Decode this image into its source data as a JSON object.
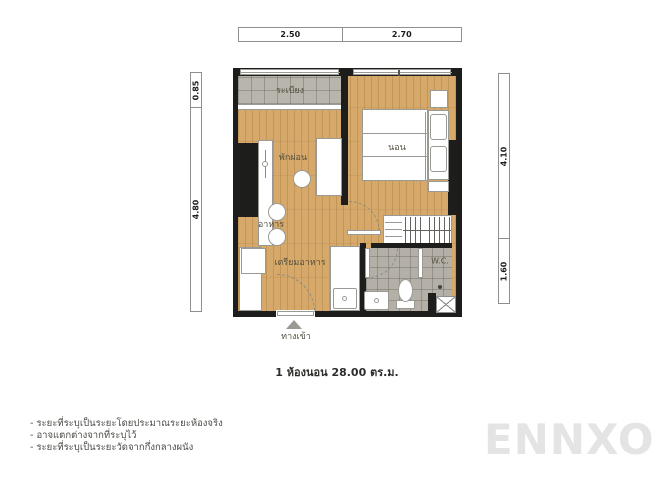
{
  "dimensions": {
    "top": [
      "2.50",
      "2.70"
    ],
    "left": [
      "0.85",
      "4.80"
    ],
    "right": [
      "4.10",
      "1.60"
    ]
  },
  "rooms": {
    "balcony": "ระเบียง",
    "living": "พักผ่อน",
    "bedroom": "นอน",
    "dining": "อาหาร",
    "kitchen": "เตรียมอาหาร",
    "wc": "W.C.",
    "entrance": "ทางเข้า"
  },
  "caption": "1 ห้องนอน 28.00 ตร.ม.",
  "notes": [
    "- ระยะที่ระบุเป็นระยะโดยประมาณระยะห้องจริง",
    "- อาจแตกต่างจากที่ระบุไว้",
    "- ระยะที่ระบุเป็นระยะวัดจากกึ่งกลางผนัง"
  ],
  "watermark": "ENNXO",
  "colors": {
    "wall": "#1d1d1b",
    "wood_floor": "#d6a96b",
    "balcony_tile": "#b8b5ad",
    "bathroom_tile": "#b4b0a8",
    "furniture": "#ffffff",
    "label_text": "#55503f",
    "watermark_gray": "#e4e4e4"
  }
}
